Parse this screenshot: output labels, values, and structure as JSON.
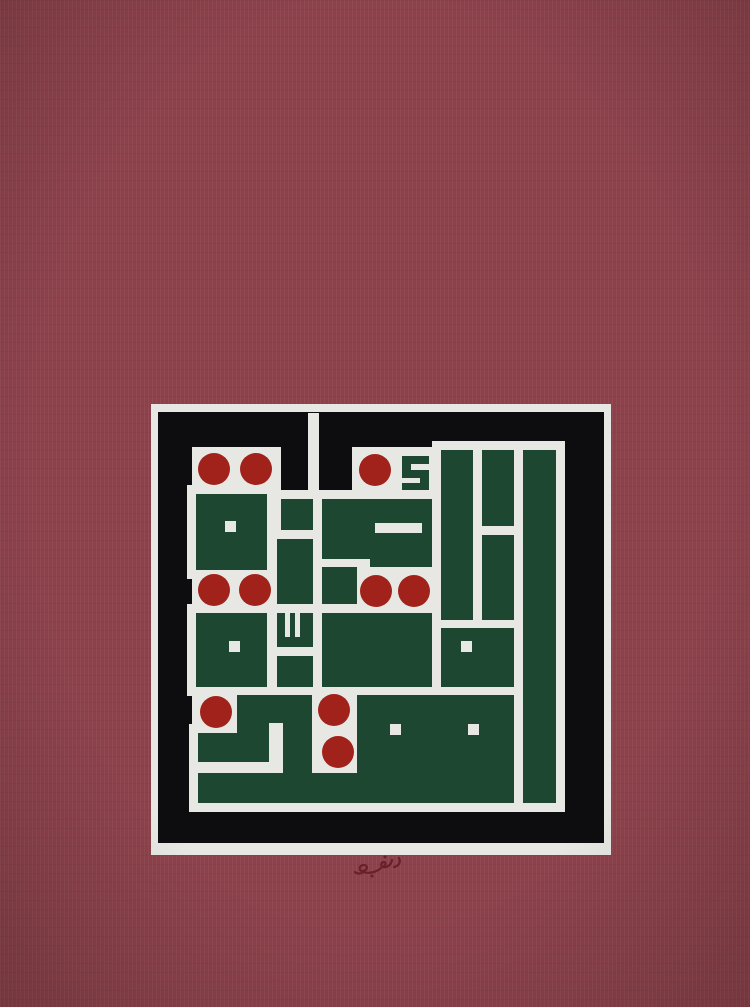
{
  "artwork": {
    "title": "Square Kufic calligraphy artwork: green geometric Arabic letterforms with red circular dots on a black panel, set in a white mat on maroon paper, artist signature below",
    "palette": {
      "background": "#8D424B",
      "mat": "#E7E8E3",
      "panel_black": "#0D0D0F",
      "letter_green": "#1E4731",
      "dot_red": "#A1221A",
      "signature": "#6A2028"
    },
    "geometry": {
      "canvas": [
        750,
        1007
      ],
      "mat": [
        151,
        404,
        460,
        451
      ],
      "panel": [
        158,
        412,
        446,
        431
      ],
      "halo": 9,
      "small_halo": 5,
      "dot_radius": 16,
      "greens": [
        [
          196,
          494,
          71,
          76
        ],
        [
          281,
          499,
          32,
          31
        ],
        [
          322,
          499,
          48,
          60
        ],
        [
          370,
          499,
          62,
          68
        ],
        [
          277,
          539,
          36,
          65
        ],
        [
          322,
          567,
          35,
          37
        ],
        [
          277,
          613,
          36,
          34
        ],
        [
          277,
          656,
          36,
          31
        ],
        [
          196,
          613,
          71,
          74
        ],
        [
          322,
          613,
          110,
          74
        ],
        [
          441,
          450,
          32,
          170
        ],
        [
          482,
          450,
          32,
          76
        ],
        [
          482,
          535,
          32,
          85
        ],
        [
          523,
          450,
          33,
          353
        ],
        [
          441,
          628,
          73,
          59
        ],
        [
          357,
          695,
          157,
          78
        ],
        [
          198,
          733,
          71,
          29
        ],
        [
          237,
          695,
          32,
          67
        ],
        [
          269,
          695,
          43,
          28
        ],
        [
          283,
          723,
          29,
          50
        ],
        [
          198,
          773,
          316,
          30
        ]
      ],
      "small_greens": [
        [
          402,
          456,
          27,
          8
        ],
        [
          402,
          464,
          9,
          6
        ],
        [
          402,
          470,
          27,
          8
        ],
        [
          420,
          478,
          9,
          6
        ],
        [
          402,
          483,
          27,
          7
        ]
      ],
      "whites": [
        [
          192,
          447,
          89,
          44
        ],
        [
          352,
          447,
          88,
          44
        ],
        [
          308,
          413,
          11,
          90
        ],
        [
          192,
          571,
          80,
          38
        ],
        [
          357,
          567,
          75,
          46
        ],
        [
          192,
          695,
          48,
          40
        ],
        [
          312,
          690,
          45,
          85
        ],
        [
          272,
          530,
          41,
          9
        ],
        [
          313,
          530,
          9,
          37
        ],
        [
          322,
          558,
          48,
          9
        ],
        [
          268,
          604,
          89,
          9
        ]
      ],
      "white_dots": [
        [
          225,
          521,
          11,
          11
        ],
        [
          229,
          641,
          11,
          11
        ],
        [
          461,
          641,
          11,
          11
        ],
        [
          390,
          724,
          11,
          11
        ],
        [
          468,
          724,
          11,
          11
        ],
        [
          375,
          523,
          47,
          10
        ],
        [
          285,
          613,
          5,
          24
        ],
        [
          295,
          613,
          5,
          24
        ]
      ],
      "red_dots": [
        [
          214,
          469
        ],
        [
          256,
          469
        ],
        [
          375,
          470
        ],
        [
          214,
          590
        ],
        [
          255,
          590
        ],
        [
          376,
          591
        ],
        [
          414,
          591
        ],
        [
          216,
          712
        ],
        [
          334,
          710
        ],
        [
          338,
          752
        ]
      ],
      "signature": {
        "x": 352,
        "y": 855,
        "path": "M47,3 c2,4 0,8 -5,9 M40,5 c-1,5 -5,8 -9,7 c-3,-1 -2,-5 1,-5 c2,0 2,3 0,4 M29,13 c-4,4 -12,6 -18,4 c-5,-2 -4,-7 1,-7 c4,0 4,5 -1,6 M10,18 c-3,1 -5,1 -7,-1",
        "dots": [
          [
            33,
            2
          ],
          [
            20,
            21
          ]
        ]
      }
    }
  }
}
